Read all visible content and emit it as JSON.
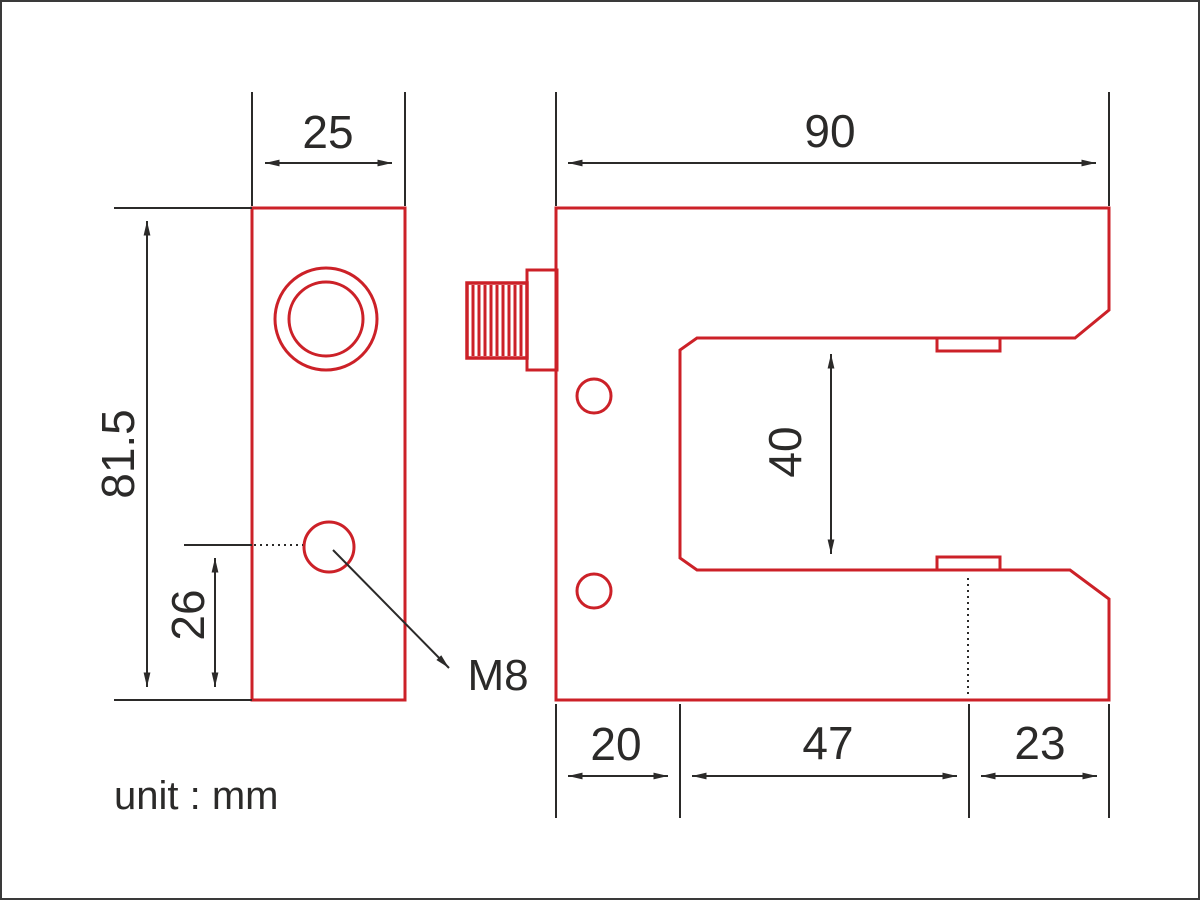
{
  "drawing": {
    "unit_note": "unit : mm",
    "colors": {
      "outline_red": "#cc2128",
      "dimension_black": "#2b2a29",
      "background": "#ffffff"
    },
    "side_view": {
      "width": "25",
      "height": "81.5",
      "hole_offset": "26",
      "hole_label": "M8"
    },
    "front_view": {
      "width": "90",
      "slot_width": "40",
      "bottom_left": "20",
      "bottom_middle": "47",
      "bottom_right": "23"
    }
  }
}
